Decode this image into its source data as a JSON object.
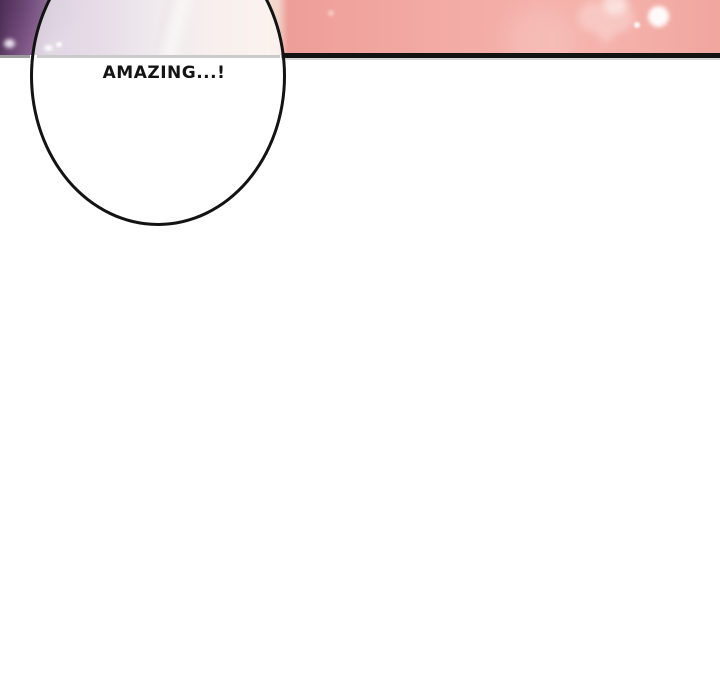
{
  "speech_bubble": {
    "text": "AMAZING...!"
  },
  "panel": {
    "decorations": [
      "light-beam",
      "sparkle-dot",
      "bokeh-glow",
      "heart-glow"
    ],
    "colors": {
      "purple_dark": "#573a60",
      "purple": "#6b4673",
      "lavender": "#b090b4",
      "pale_cream": "#f2d8cc",
      "salmon": "#ee9e98",
      "salmon_light": "#f5b3ac",
      "divider_black": "#131313",
      "divider_gray": "#9c9c9c",
      "divider_gray_light": "#cbcbcb",
      "shadow_gray": "#d6d6d6",
      "bubble_fill": "rgba(255,255,255,0.68)",
      "bubble_outline": "#131313",
      "text_color": "#141414",
      "page_background": "#ffffff"
    }
  }
}
